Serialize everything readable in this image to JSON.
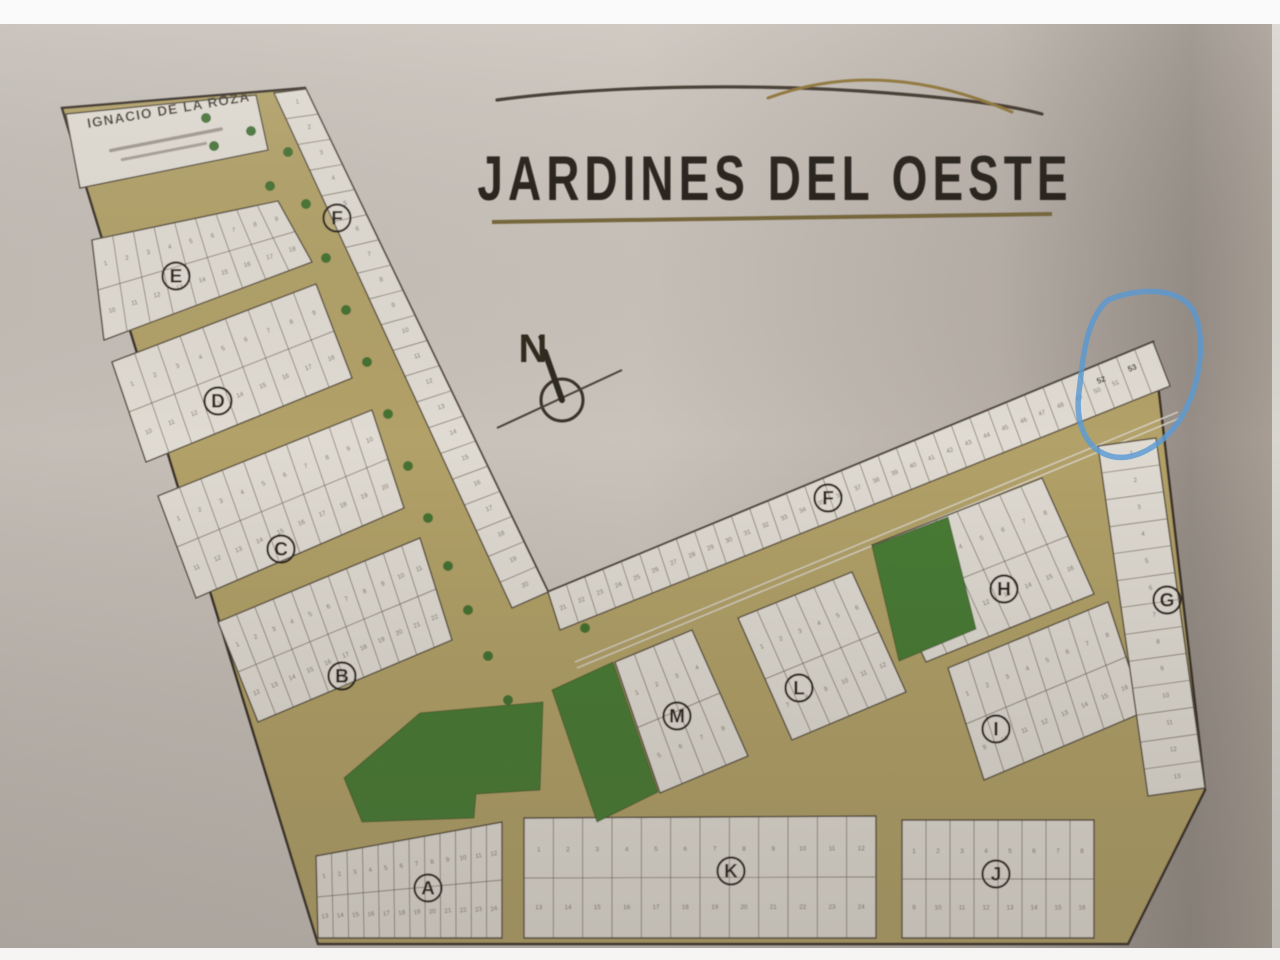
{
  "logo": {
    "title": "JARDINES DEL OESTE"
  },
  "map": {
    "street_label": "IGNACIO DE LA ROZA",
    "compass_label": "N",
    "blocks": [
      {
        "label": "A"
      },
      {
        "label": "B"
      },
      {
        "label": "C"
      },
      {
        "label": "D"
      },
      {
        "label": "E"
      },
      {
        "label": "F"
      },
      {
        "label": "F"
      },
      {
        "label": "G"
      },
      {
        "label": "H"
      },
      {
        "label": "I"
      },
      {
        "label": "J"
      },
      {
        "label": "K"
      },
      {
        "label": "L"
      },
      {
        "label": "M"
      }
    ],
    "highlight": {
      "lots": [
        "52",
        "53"
      ],
      "color": "#5b9bd5"
    },
    "colors": {
      "street": "#b2a167",
      "park": "#4a7c35",
      "lot": "#e0dbd2",
      "paper": "#c7c0b9",
      "ink": "#4d4539",
      "logo_accent": "#8a6f33"
    }
  }
}
